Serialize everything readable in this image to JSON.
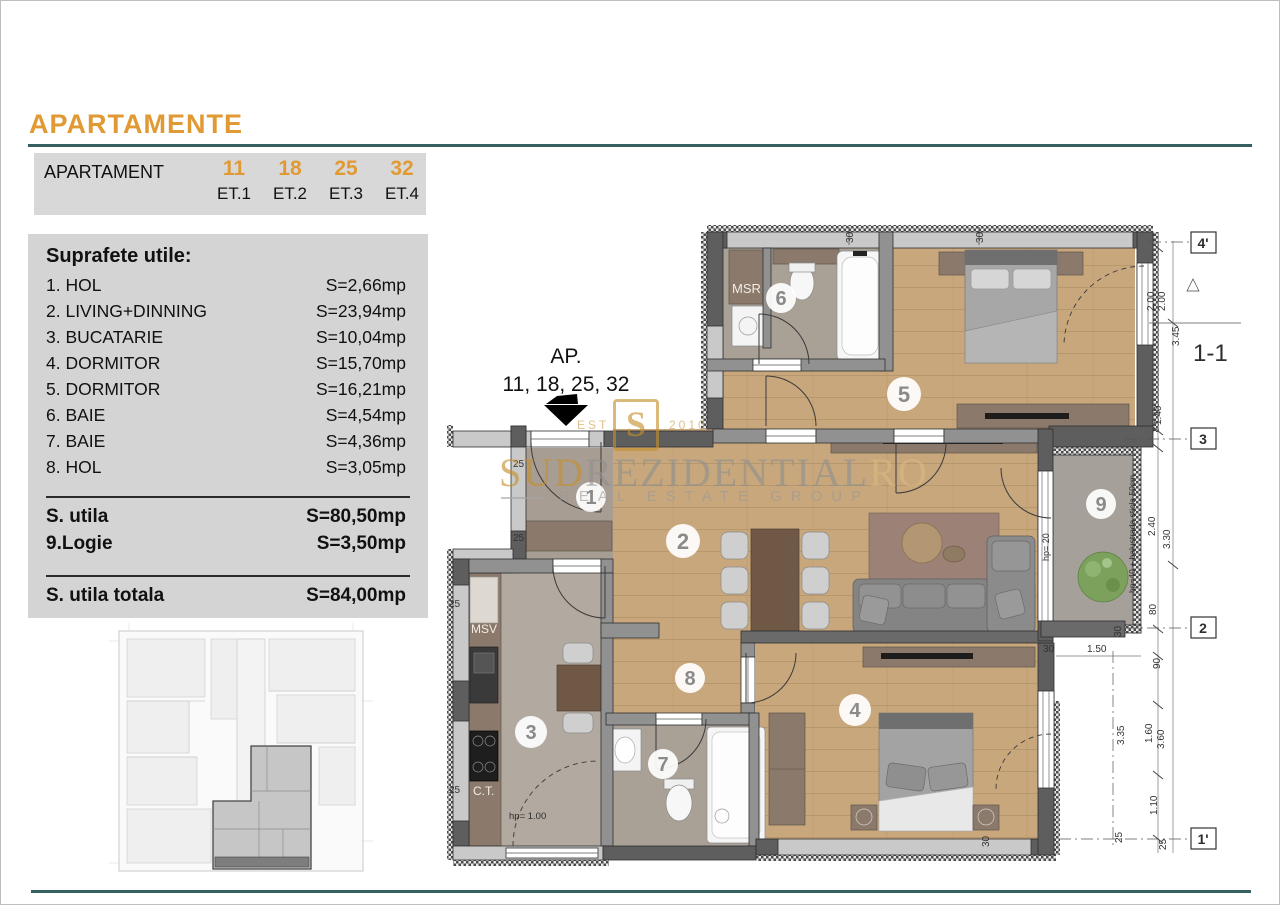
{
  "page": {
    "title": "APARTAMENTE",
    "accent_color": "#e19a33",
    "rule_color": "#35605f"
  },
  "apartments_table": {
    "label": "APARTAMENT",
    "units": [
      {
        "number": "11",
        "floor": "ET.1"
      },
      {
        "number": "18",
        "floor": "ET.2"
      },
      {
        "number": "25",
        "floor": "ET.3"
      },
      {
        "number": "32",
        "floor": "ET.4"
      }
    ]
  },
  "areas_panel": {
    "title": "Suprafete utile:",
    "rows": [
      {
        "label": "1. HOL",
        "value": "S=2,66mp"
      },
      {
        "label": "2. LIVING+DINNING",
        "value": "S=23,94mp"
      },
      {
        "label": "3. BUCATARIE",
        "value": "S=10,04mp"
      },
      {
        "label": "4. DORMITOR",
        "value": "S=15,70mp"
      },
      {
        "label": "5. DORMITOR",
        "value": "S=16,21mp"
      },
      {
        "label": "6. BAIE",
        "value": "S=4,54mp"
      },
      {
        "label": "7. BAIE",
        "value": "S=4,36mp"
      },
      {
        "label": "8. HOL",
        "value": "S=3,05mp"
      }
    ],
    "subtotal_rows": [
      {
        "label": "S. utila",
        "value": "S=80,50mp"
      },
      {
        "label": "9.Logie",
        "value": "S=3,50mp"
      }
    ],
    "total_row": {
      "label": "S. utila totala",
      "value": "S=84,00mp"
    }
  },
  "plan": {
    "ap_callout_line1": "AP.",
    "ap_callout_line2": "11, 18, 25, 32",
    "rooms": {
      "r1": "1",
      "r2": "2",
      "r3": "3",
      "r4": "4",
      "r5": "5",
      "r6": "6",
      "r7": "7",
      "r8": "8",
      "r9": "9"
    },
    "labels": {
      "msr": "MSR",
      "msv": "MSV",
      "ct": "C.T."
    },
    "axes": {
      "a4": "4'",
      "a3": "3",
      "a2": "2",
      "a1": "1'"
    },
    "section": "1-1",
    "dims": {
      "v200a": "2.00",
      "v200b": "2.00",
      "v345": "3.45",
      "v140": "1.40",
      "v240": "2.40",
      "v330": "3.30",
      "v80": "80",
      "v90": "90",
      "v160": "1.60",
      "v360": "3.60",
      "v110": "1.10",
      "v335": "3.35",
      "v150": "1.50",
      "v25a": "25",
      "v25b": "25",
      "v25c": "25",
      "v25d": "25",
      "v25e": "25",
      "v25f": "25",
      "v30a": "30",
      "v30b": "30",
      "v30c": "30",
      "v30d": "30",
      "v30e": "30"
    },
    "notes": {
      "hp20": "hp= 20",
      "hp40": "hp=40 + balustrada sticla 50cm",
      "hp100": "hp= 1.00"
    }
  },
  "watermark": {
    "logo_letter": "S",
    "est": "EST",
    "year": "2010",
    "brand_gold": "SUD",
    "brand_gray": "REZIDENTIAL",
    "brand_suffix": "RO",
    "subtitle": "REAL ESTATE GROUP"
  }
}
